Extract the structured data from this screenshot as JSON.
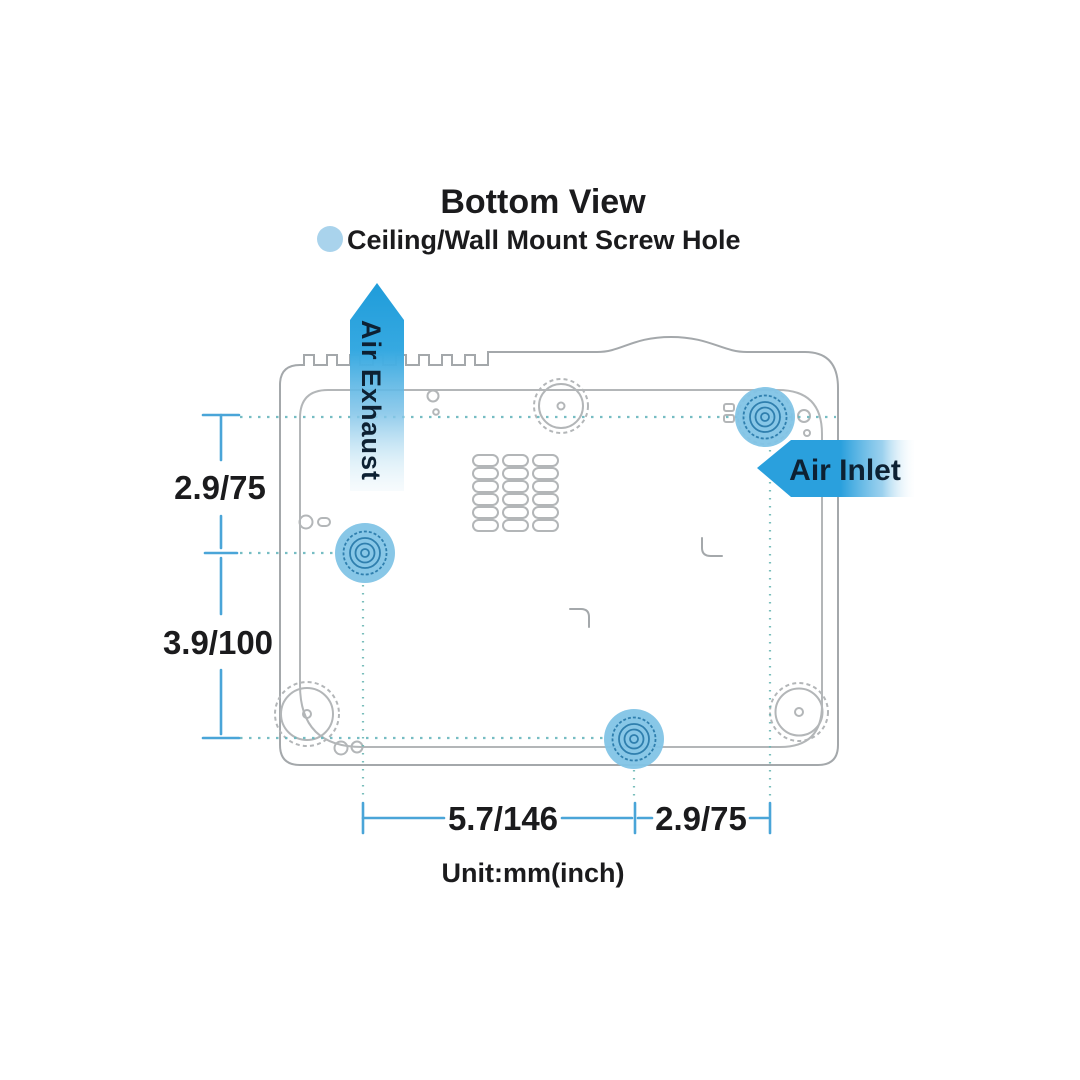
{
  "title": "Bottom View",
  "legend": {
    "label": "Ceiling/Wall Mount Screw Hole",
    "dot_color": "#a9d3ec"
  },
  "airflow": {
    "exhaust_label": "Air Exhaust",
    "inlet_label": "Air Inlet"
  },
  "dimensions": {
    "left_top": "2.9/75",
    "left_bottom": "3.9/100",
    "bottom_left_span": "5.7/146",
    "bottom_right_span": "2.9/75",
    "unit_note": "Unit:mm(inch)"
  },
  "colors": {
    "arrow_blue": "#2aa0dd",
    "screw_hole_fill": "#82c4e6",
    "screw_hole_ring": "#2f7fae",
    "dimension_line": "#4aa5d8",
    "construction_line": "#67b6bc",
    "outline_gray": "#a4a8ab",
    "label_text": "#1b1b1d",
    "arrow_text": "#0d2133"
  }
}
